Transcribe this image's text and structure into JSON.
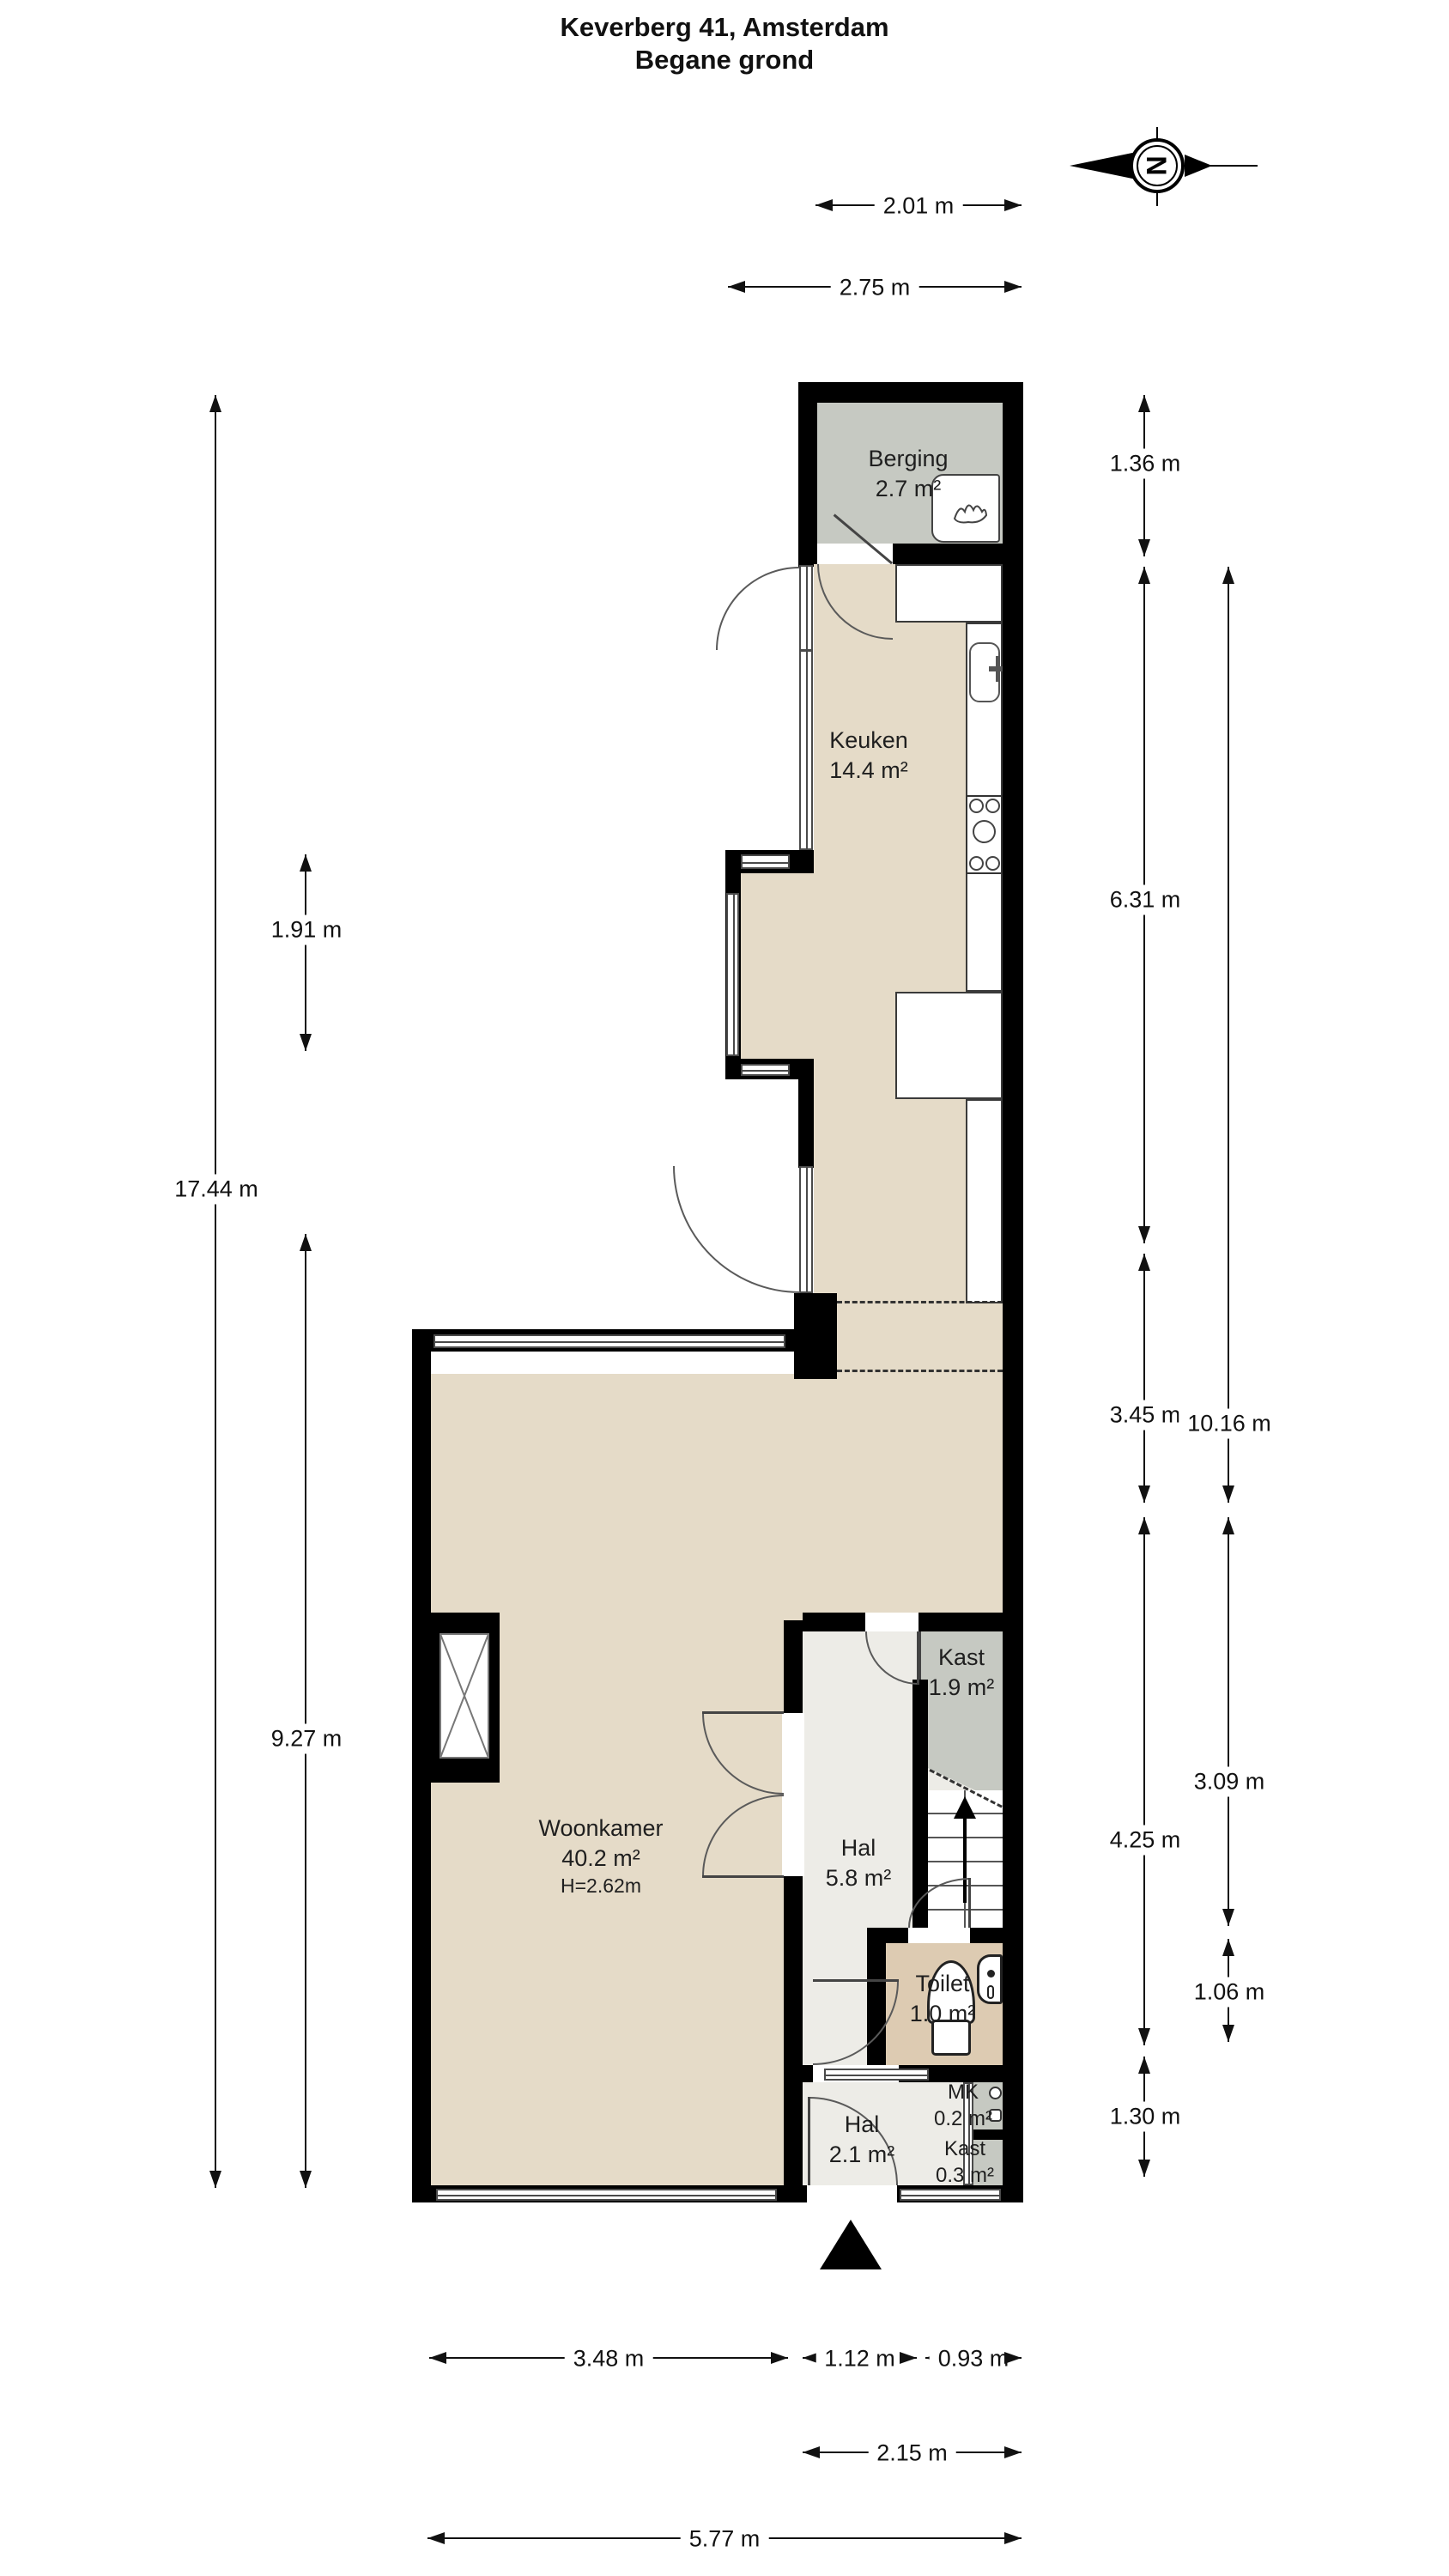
{
  "title": {
    "line1": "Keverberg 41, Amsterdam",
    "line2": "Begane grond"
  },
  "compass": {
    "letter": "N"
  },
  "rooms": {
    "berging": {
      "name": "Berging",
      "area": "2.7 m²"
    },
    "keuken": {
      "name": "Keuken",
      "area": "14.4 m²"
    },
    "woonkamer": {
      "name": "Woonkamer",
      "area": "40.2 m²",
      "ceiling": "H=2.62m"
    },
    "kast_boven": {
      "name": "Kast",
      "area": "1.9 m²"
    },
    "hal_groot": {
      "name": "Hal",
      "area": "5.8 m²"
    },
    "toilet": {
      "name": "Toilet",
      "area": "1.0 m²"
    },
    "mk": {
      "name": "MK",
      "area": "0.2 m²"
    },
    "hal_klein": {
      "name": "Hal",
      "area": "2.1 m²"
    },
    "kast_klein": {
      "name": "Kast",
      "area": "0.3 m²"
    }
  },
  "dimensions": {
    "top_inner": "2.01 m",
    "top_outer": "2.75 m",
    "left_total": "17.44 m",
    "left_window": "1.91 m",
    "left_lower": "9.27 m",
    "right_berging": "1.36 m",
    "right_keuken": "6.31 m",
    "right_mid": "3.45 m",
    "right_hal": "4.25 m",
    "right_entree": "1.30 m",
    "right_outer_total": "10.16 m",
    "right_outer_mid": "3.09 m",
    "right_outer_low": "1.06 m",
    "bottom_livingroom": "3.48 m",
    "bottom_door": "1.12 m",
    "bottom_kast": "0.93 m",
    "bottom_inner": "2.15 m",
    "bottom_total": "5.77 m"
  },
  "colors": {
    "wall": "#000000",
    "floor_main": "#e5dbc8",
    "floor_hal": "#edece7",
    "floor_gray": "#c6c9c2",
    "floor_toilet": "#ddcbb2"
  }
}
